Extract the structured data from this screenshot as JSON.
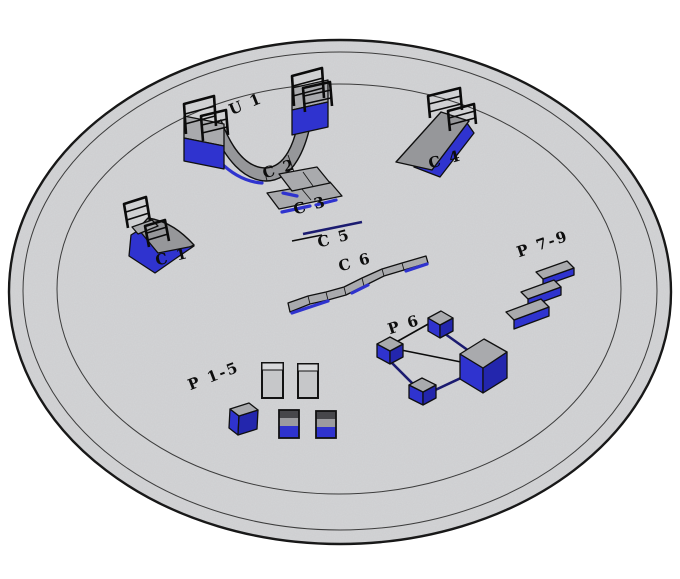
{
  "palette": {
    "background": "#ffffff",
    "platform_fill": "#d3d4d6",
    "platform_edge": "#161616",
    "ring_line": "#3c3c3c",
    "gray_top": "#a9aaad",
    "gray_ramp": "#96979a",
    "blue": "#2f33cf",
    "blue_dark": "#2326ad",
    "navy": "#1b1b70",
    "label_color": "#0d0d0d"
  },
  "labels": {
    "u1": "U 1",
    "c1": "C 1",
    "c2": "C 2",
    "c3": "C 3",
    "c4": "C 4",
    "c5": "C 5",
    "c6": "C 6",
    "p1_5": "P 1-5",
    "p6": "P 6",
    "p7_9": "P 7-9"
  }
}
